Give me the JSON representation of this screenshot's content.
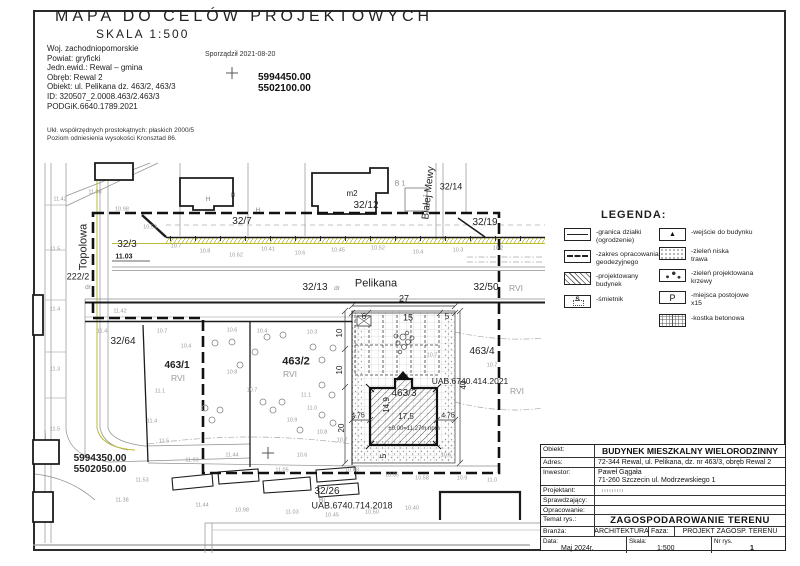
{
  "header": {
    "title": "MAPA DO CELÓW PROJEKTOWYCH",
    "scale": "SKALA 1:500",
    "info": [
      "Woj. zachodniopomorskie",
      "Powiat:   gryficki",
      "Jedn.ewid.: Rewal  –  gmina",
      "Obręb: Rewal 2",
      "Obiekt: ul. Pelikana dz. 463/2, 463/3",
      "ID:  320507_2.0008.463/2.463/3",
      "PODGiK.6640.1789.2021"
    ],
    "prepared": "Sporządził 2021-08-20",
    "coord_n": "5994450.00",
    "coord_e": "5502100.00",
    "datum": [
      "Ukł. współrzędnych prostokątnych: płaskich 2000/5",
      "Poziom odniesienia wysokości Kronsztad 86."
    ]
  },
  "legend": {
    "title": "LEGENDA:",
    "left": [
      {
        "sym": "fence",
        "label": "-granica działki\n(ogrodzenie)"
      },
      {
        "sym": "dash",
        "label": "-zakres opracowania\ngeodezyjnego"
      },
      {
        "sym": "hatch",
        "label": "-projektowany budynek"
      },
      {
        "sym": "bin",
        "glyph": "S",
        "label": "-śmietnik"
      }
    ],
    "right": [
      {
        "sym": "entry",
        "glyph": "▲",
        "label": "-wejście do budynku"
      },
      {
        "sym": "grass",
        "label": "-zieleń niska\ntrawa"
      },
      {
        "sym": "shrub",
        "label": "-zieleń projektowana\nkrzewy"
      },
      {
        "sym": "parking",
        "glyph": "P",
        "label": "-miejsca postojowe\nx15"
      },
      {
        "sym": "paving",
        "label": "-kostka betonowa"
      }
    ]
  },
  "titleblock": {
    "obiekt_label": "Obiekt:",
    "obiekt_value": "BUDYNEK MIESZKALNY WIELORODZINNY",
    "adres_label": "Adres:",
    "adres_value": "72-344 Rewal, ul. Pelikana, dz. nr 463/3, obręb Rewal 2",
    "inwestor_label": "Inwestor:",
    "inwestor_value": "Paweł Gągała\n71-260 Szczecin ul. Modrzewskiego 1",
    "projektant_label": "Projektant:",
    "sprawdzajacy_label": "Sprawdzający:",
    "opracowanie_label": "Opracowanie:",
    "temat_label": "Temat rys.:",
    "temat_value": "ZAGOSPODAROWANIE TERENU",
    "branza_label": "Branża:",
    "branza_value": "ARCHITEKTURA",
    "faza_label": "Faza:",
    "faza_value": "PROJEKT ZAGOSP. TERENU",
    "data_label": "Data:",
    "data_value": "Maj 2024r.",
    "skala_label": "Skala:",
    "skala_value": "1:500",
    "nr_label": "Nr rys.",
    "nr_value": "1"
  },
  "map": {
    "labels": [
      {
        "t": "Topolowa",
        "x": 84,
        "y": 247,
        "s": 11,
        "r": -90
      },
      {
        "t": "222/2",
        "x": 78,
        "y": 277,
        "s": 9
      },
      {
        "t": "dr",
        "x": 88,
        "y": 288,
        "s": 6.5,
        "c": "#8a8a8a"
      },
      {
        "t": "32/3",
        "x": 127,
        "y": 245,
        "s": 10
      },
      {
        "t": "11.03",
        "x": 124,
        "y": 257,
        "s": 7,
        "b": true
      },
      {
        "t": "32/7",
        "x": 242,
        "y": 222,
        "s": 10
      },
      {
        "t": "H",
        "x": 208,
        "y": 200,
        "s": 6,
        "c": "#777777"
      },
      {
        "t": "H",
        "x": 233,
        "y": 196,
        "s": 6,
        "c": "#777777"
      },
      {
        "t": "H",
        "x": 258,
        "y": 211,
        "s": 6,
        "c": "#777777"
      },
      {
        "t": "m2",
        "x": 352,
        "y": 194,
        "s": 8
      },
      {
        "t": "32/12",
        "x": 366,
        "y": 206,
        "s": 10
      },
      {
        "t": "B 1",
        "x": 400,
        "y": 184,
        "s": 7,
        "c": "#888888"
      },
      {
        "t": "Białej Mewy",
        "x": 429,
        "y": 193,
        "s": 10,
        "r": -84
      },
      {
        "t": "32/14",
        "x": 451,
        "y": 187,
        "s": 9
      },
      {
        "t": "32/19",
        "x": 485,
        "y": 223,
        "s": 10
      },
      {
        "t": "32/13",
        "x": 315,
        "y": 288,
        "s": 10
      },
      {
        "t": "dr",
        "x": 337,
        "y": 289,
        "s": 6.5,
        "c": "#8a8a8a"
      },
      {
        "t": "Pelikana",
        "x": 376,
        "y": 284,
        "s": 11
      },
      {
        "t": "27",
        "x": 404,
        "y": 299,
        "s": 9
      },
      {
        "t": "32/50",
        "x": 486,
        "y": 288,
        "s": 10
      },
      {
        "t": "RVI",
        "x": 516,
        "y": 288,
        "s": 8.5,
        "c": "#999999"
      },
      {
        "t": "32/64",
        "x": 123,
        "y": 342,
        "s": 10
      },
      {
        "t": "463/1",
        "x": 177,
        "y": 366,
        "s": 10,
        "b": true
      },
      {
        "t": "RVI",
        "x": 178,
        "y": 378,
        "s": 8.5,
        "c": "#999999"
      },
      {
        "t": "463/2",
        "x": 296,
        "y": 362,
        "s": 11,
        "b": true
      },
      {
        "t": "RVI",
        "x": 290,
        "y": 374,
        "s": 8.5,
        "c": "#999999"
      },
      {
        "t": "463/4",
        "x": 482,
        "y": 352,
        "s": 10
      },
      {
        "t": "UAB.6740.414.2021",
        "x": 470,
        "y": 381,
        "s": 8.5
      },
      {
        "t": "RVI",
        "x": 517,
        "y": 391,
        "s": 8.5,
        "c": "#999999"
      },
      {
        "t": "463/3",
        "x": 404,
        "y": 394,
        "s": 10
      },
      {
        "t": "14,9",
        "x": 387,
        "y": 405,
        "s": 8,
        "r": -90
      },
      {
        "t": "17,5",
        "x": 406,
        "y": 417,
        "s": 8
      },
      {
        "t": "4.75",
        "x": 358,
        "y": 416,
        "s": 7
      },
      {
        "t": "4.75",
        "x": 448,
        "y": 416,
        "s": 7
      },
      {
        "t": "±0.00=11,27m npm",
        "x": 414,
        "y": 429,
        "s": 6,
        "c": "#333333"
      },
      {
        "t": "6",
        "x": 364,
        "y": 317,
        "s": 8
      },
      {
        "t": "15",
        "x": 408,
        "y": 318,
        "s": 9
      },
      {
        "t": "5",
        "x": 447,
        "y": 317,
        "s": 8
      },
      {
        "t": "10",
        "x": 340,
        "y": 333,
        "s": 8,
        "r": -90
      },
      {
        "t": "10",
        "x": 340,
        "y": 370,
        "s": 8,
        "r": -90
      },
      {
        "t": "20",
        "x": 342,
        "y": 428,
        "s": 8,
        "r": -90
      },
      {
        "t": "40",
        "x": 464,
        "y": 385,
        "s": 8,
        "r": -90
      },
      {
        "t": "5",
        "x": 384,
        "y": 456,
        "s": 8,
        "r": -90
      },
      {
        "t": "32/26",
        "x": 327,
        "y": 492,
        "s": 10
      },
      {
        "t": "Bi",
        "x": 322,
        "y": 501,
        "s": 7,
        "c": "#999999"
      },
      {
        "t": "UAB.6740.714.2018",
        "x": 352,
        "y": 506,
        "s": 9
      },
      {
        "t": "5994350.00",
        "x": 100,
        "y": 459,
        "s": 10,
        "b": true
      },
      {
        "t": "5502050.00",
        "x": 100,
        "y": 470,
        "s": 10,
        "b": true
      }
    ],
    "spots": [
      [
        60,
        200,
        "11.42"
      ],
      [
        95,
        193,
        "11.08"
      ],
      [
        122,
        210,
        "10.98"
      ],
      [
        150,
        228,
        "10.53"
      ],
      [
        176,
        247,
        "10.7"
      ],
      [
        205,
        252,
        "10.8"
      ],
      [
        236,
        256,
        "10.62"
      ],
      [
        268,
        250,
        "10.41"
      ],
      [
        300,
        254,
        "10.6"
      ],
      [
        338,
        251,
        "10.45"
      ],
      [
        378,
        249,
        "10.52"
      ],
      [
        418,
        253,
        "10.4"
      ],
      [
        458,
        251,
        "10.3"
      ],
      [
        498,
        249,
        "10.2"
      ],
      [
        120,
        312,
        "11.42"
      ],
      [
        102,
        332,
        "11.4"
      ],
      [
        162,
        332,
        "10.7"
      ],
      [
        186,
        347,
        "10.4"
      ],
      [
        232,
        331,
        "10.6"
      ],
      [
        262,
        332,
        "10.4"
      ],
      [
        312,
        333,
        "10.3"
      ],
      [
        160,
        392,
        "11.1"
      ],
      [
        152,
        422,
        "11.4"
      ],
      [
        164,
        442,
        "11.5"
      ],
      [
        232,
        373,
        "10.8"
      ],
      [
        252,
        391,
        "10.7"
      ],
      [
        306,
        396,
        "11.1"
      ],
      [
        312,
        409,
        "11.0"
      ],
      [
        292,
        421,
        "10.9"
      ],
      [
        322,
        433,
        "10.8"
      ],
      [
        342,
        441,
        "10.7"
      ],
      [
        432,
        356,
        "10.7"
      ],
      [
        492,
        366,
        "10.7"
      ],
      [
        446,
        456,
        "10.6"
      ],
      [
        302,
        456,
        "10.6"
      ],
      [
        232,
        456,
        "11.44"
      ],
      [
        192,
        461,
        "11.03"
      ],
      [
        282,
        471,
        "11.05"
      ],
      [
        352,
        471,
        "10.68"
      ],
      [
        392,
        476,
        "10.65"
      ],
      [
        422,
        479,
        "10.58"
      ],
      [
        462,
        479,
        "10.9"
      ],
      [
        492,
        481,
        "11.0"
      ],
      [
        142,
        481,
        "11.53"
      ],
      [
        122,
        501,
        "11.38"
      ],
      [
        202,
        506,
        "11.44"
      ],
      [
        242,
        511,
        "10.98"
      ],
      [
        292,
        513,
        "11.03"
      ],
      [
        332,
        516,
        "10.45"
      ],
      [
        372,
        513,
        "10.50"
      ],
      [
        412,
        509,
        "10.40"
      ],
      [
        55,
        250,
        "11.5"
      ],
      [
        55,
        310,
        "11.4"
      ],
      [
        55,
        370,
        "11.3"
      ],
      [
        55,
        430,
        "11.5"
      ]
    ]
  }
}
